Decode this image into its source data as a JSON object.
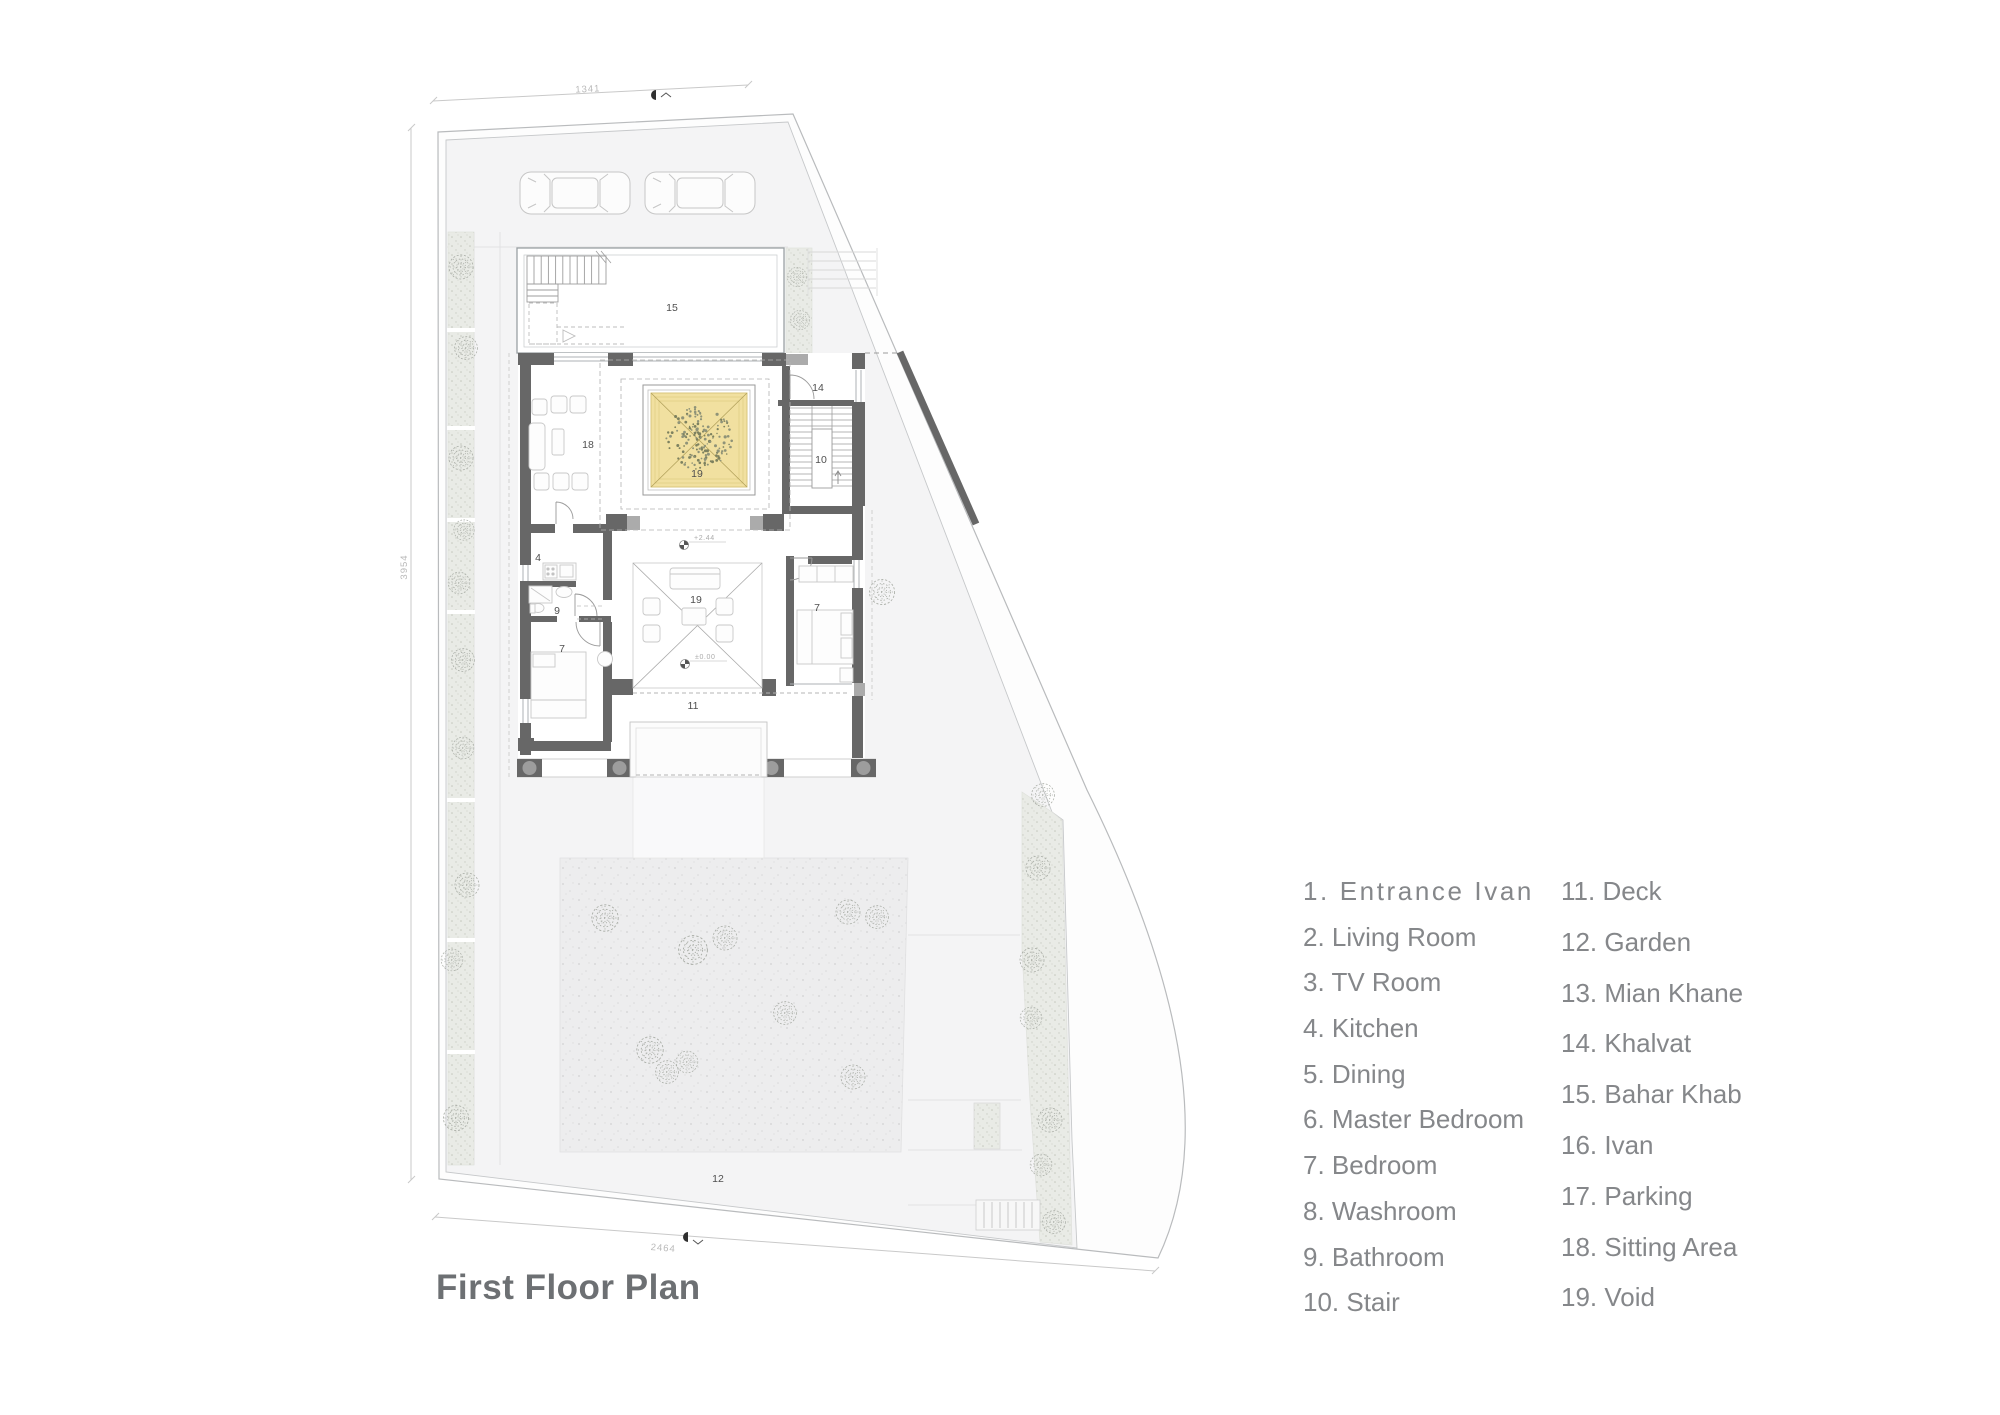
{
  "title": "First Floor Plan",
  "legend": {
    "column1": [
      {
        "num": "1.",
        "label": "Entrance Ivan"
      },
      {
        "num": "2.",
        "label": "Living Room"
      },
      {
        "num": "3.",
        "label": "TV Room"
      },
      {
        "num": "4.",
        "label": "Kitchen"
      },
      {
        "num": "5.",
        "label": "Dining"
      },
      {
        "num": "6.",
        "label": "Master Bedroom"
      },
      {
        "num": "7.",
        "label": "Bedroom"
      },
      {
        "num": "8.",
        "label": "Washroom"
      },
      {
        "num": "9.",
        "label": "Bathroom"
      },
      {
        "num": "10.",
        "label": "Stair"
      }
    ],
    "column2": [
      {
        "num": "11.",
        "label": "Deck"
      },
      {
        "num": "12.",
        "label": "Garden"
      },
      {
        "num": "13.",
        "label": "Mian Khane"
      },
      {
        "num": "14.",
        "label": "Khalvat"
      },
      {
        "num": "15.",
        "label": "Bahar Khab"
      },
      {
        "num": "16.",
        "label": "Ivan"
      },
      {
        "num": "17.",
        "label": "Parking"
      },
      {
        "num": "18.",
        "label": "Sitting Area"
      },
      {
        "num": "19.",
        "label": "Void"
      }
    ]
  },
  "dimensions": {
    "top": "1341",
    "left": "3954",
    "bottom": "2464"
  },
  "room_labels": [
    {
      "n": "15",
      "x": 672,
      "y": 311
    },
    {
      "n": "14",
      "x": 818,
      "y": 391
    },
    {
      "n": "10",
      "x": 821,
      "y": 463
    },
    {
      "n": "18",
      "x": 588,
      "y": 448
    },
    {
      "n": "19",
      "x": 697,
      "y": 477
    },
    {
      "n": "4",
      "x": 538,
      "y": 561
    },
    {
      "n": "9",
      "x": 557,
      "y": 614
    },
    {
      "n": "19",
      "x": 696,
      "y": 603
    },
    {
      "n": "7",
      "x": 562,
      "y": 652
    },
    {
      "n": "7",
      "x": 817,
      "y": 611
    },
    {
      "n": "11",
      "x": 693,
      "y": 709
    },
    {
      "n": "12",
      "x": 718,
      "y": 1182
    }
  ],
  "level_markers": [
    {
      "text": "+2.44",
      "x": 684,
      "y": 545
    },
    {
      "text": "±0.00",
      "x": 685,
      "y": 664
    }
  ],
  "colors": {
    "skylight_yellow": "#f1e0a0",
    "wall_gray": "#676767",
    "legend_text": "#85878a",
    "title_text": "#6d7073"
  }
}
